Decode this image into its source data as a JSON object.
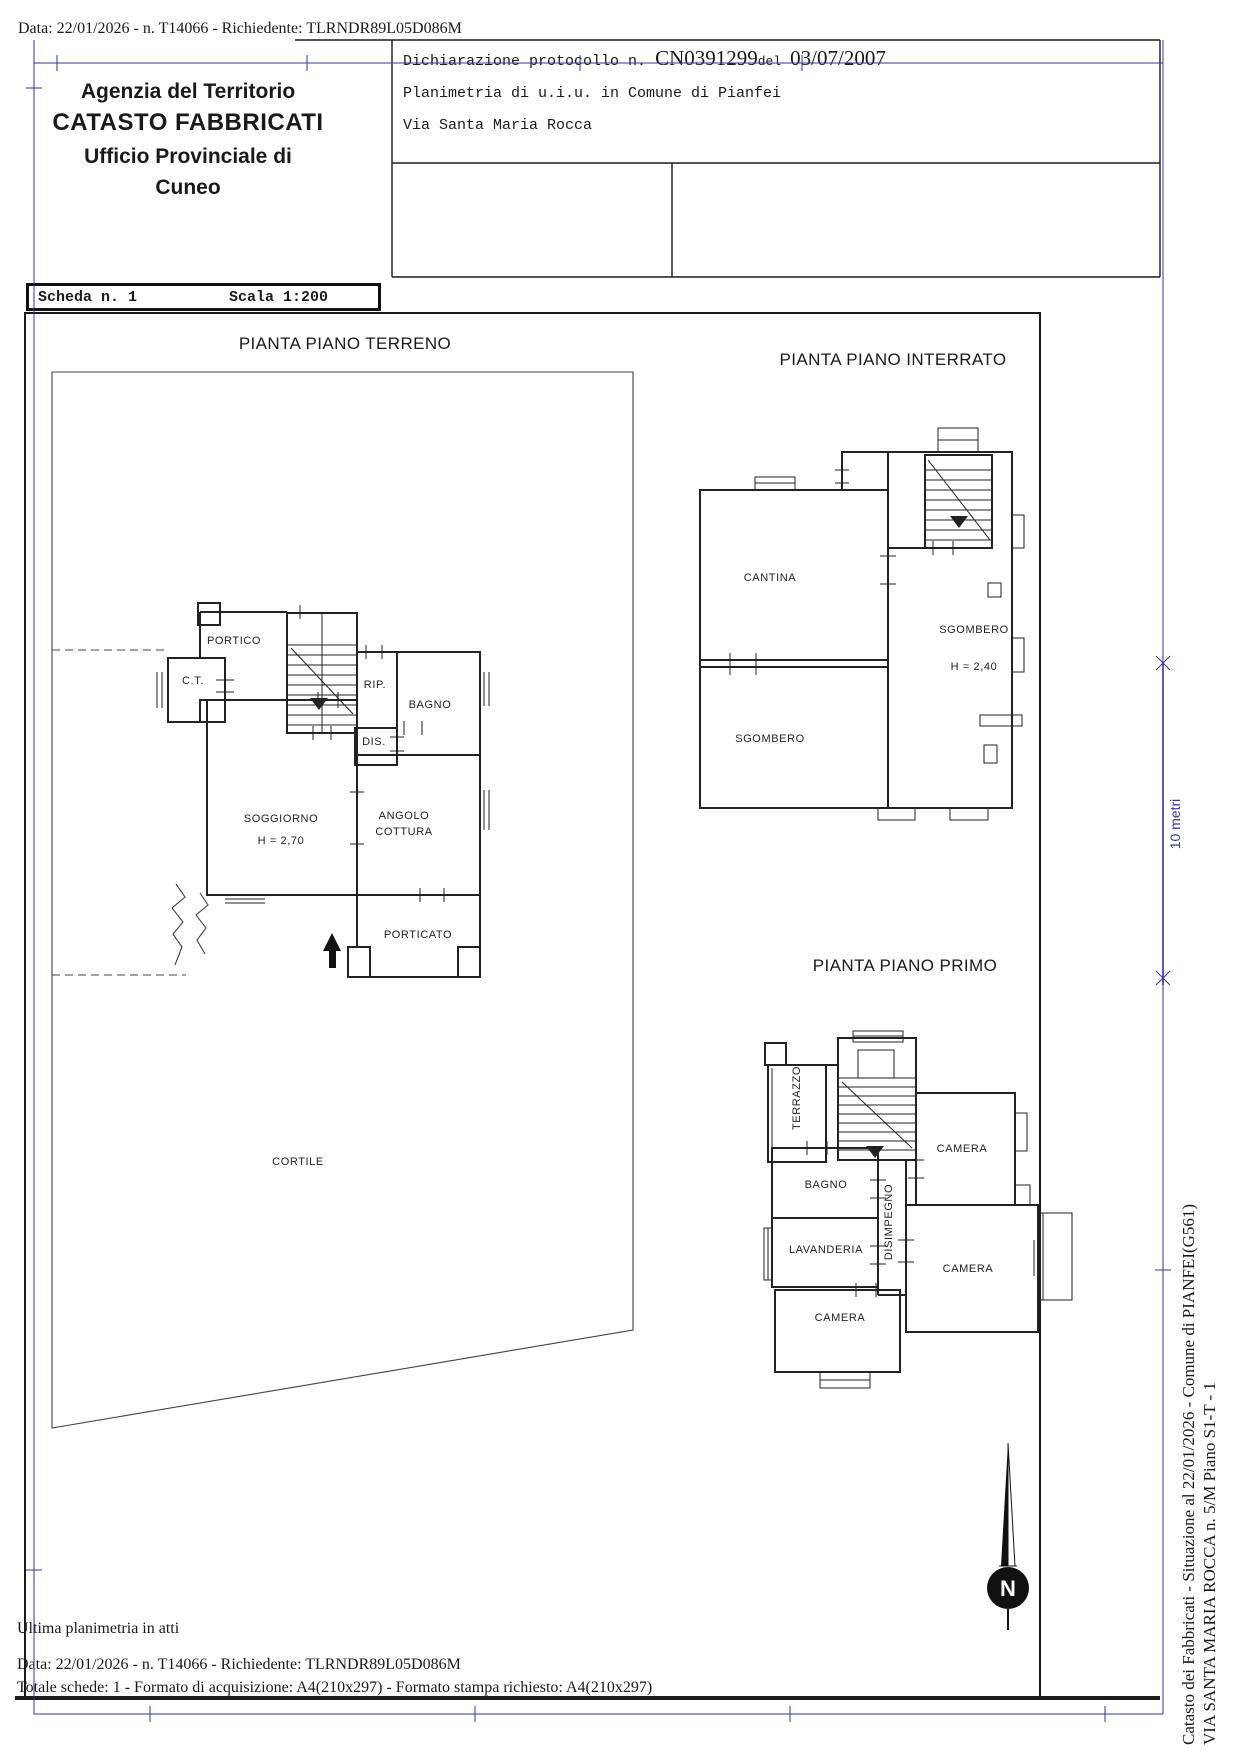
{
  "doc": {
    "header_line": "Data: 22/01/2026 - n. T14066 - Richiedente: TLRNDR89L05D086M",
    "agency": {
      "l1": "Agenzia del Territorio",
      "l2": "CATASTO FABBRICATI",
      "l3": "Ufficio Provinciale di",
      "l4": "Cuneo"
    },
    "declaration": {
      "label": "Dichiarazione protocollo n.",
      "protocol": "CN0391299",
      "del_label": "del",
      "date": "03/07/2007",
      "object": "Planimetria di u.i.u. in Comune di Pianfei",
      "address": "Via Santa Maria Rocca"
    },
    "sheet_box": {
      "scheda": "Scheda n. 1",
      "scala": "Scala 1:200"
    },
    "footer": {
      "l1": "Ultima planimetria in atti",
      "l2": "Data: 22/01/2026 - n. T14066 - Richiedente: TLRNDR89L05D086M",
      "l3": "Totale schede: 1 - Formato di acquisizione: A4(210x297)  - Formato stampa richiesto: A4(210x297)"
    },
    "side": {
      "l1": "Catasto dei Fabbricati - Situazione al 22/01/2026 - Comune di PIANFEI(G561)",
      "l2": "VIA SANTA MARIA ROCCA n. 5/M Piano S1-T - 1"
    },
    "scale_bar_label": "10 metri",
    "compass_label": "N"
  },
  "plans": {
    "terreno": {
      "title": "PIANTA PIANO TERRENO",
      "labels": {
        "portico": "PORTICO",
        "ct": "C.T.",
        "rip": "RIP.",
        "bagno": "BAGNO",
        "dis": "DIS.",
        "soggiorno": "SOGGIORNO",
        "soggiorno_h": "H = 2,70",
        "angolo1": "ANGOLO",
        "angolo2": "COTTURA",
        "porticato": "PORTICATO",
        "cortile": "CORTILE"
      }
    },
    "interrato": {
      "title": "PIANTA PIANO INTERRATO",
      "labels": {
        "cantina": "CANTINA",
        "sgombero_dx": "SGOMBERO",
        "sgombero_dx_h": "H = 2,40",
        "sgombero_sx": "SGOMBERO"
      }
    },
    "primo": {
      "title": "PIANTA PIANO PRIMO",
      "labels": {
        "terrazzo": "TERRAZZO",
        "bagno": "BAGNO",
        "lavanderia": "LAVANDERIA",
        "disimpegno": "DISIMPEGNO",
        "camera1": "CAMERA",
        "camera2": "CAMERA",
        "camera3": "CAMERA"
      }
    }
  },
  "colors": {
    "registration_blue": "#34349b",
    "ink": "#1b1b1b"
  }
}
